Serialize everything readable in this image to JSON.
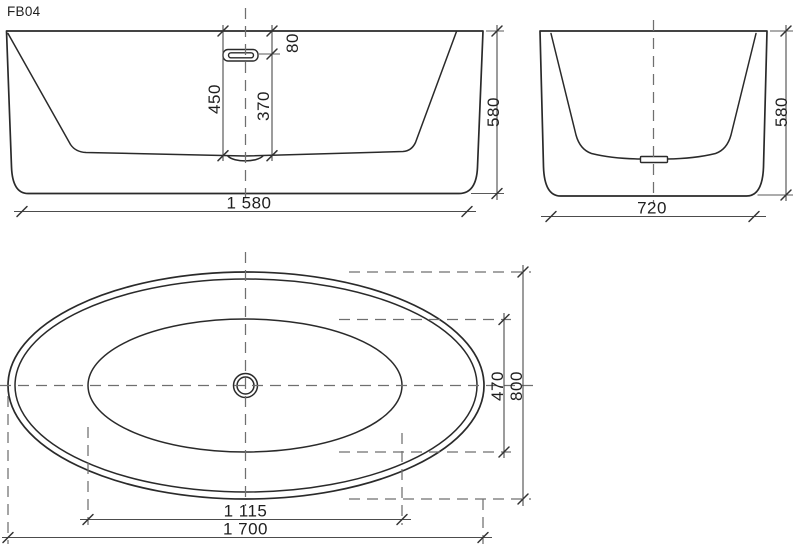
{
  "title": "FB04",
  "colors": {
    "line": "#2a2a2a",
    "dimension": "#4c4c4c",
    "dashed": "#6f6f6f",
    "background": "#ffffff"
  },
  "views": {
    "front": {
      "inner_depth": "450",
      "overflow_to_floor": "370",
      "rim_to_overflow": "80",
      "base_length": "1 580",
      "overall_height": "580"
    },
    "side": {
      "base_width": "720",
      "overall_height": "580"
    },
    "plan": {
      "floor_length": "1 115",
      "overall_length": "1 700",
      "floor_width": "470",
      "overall_width": "800"
    }
  }
}
